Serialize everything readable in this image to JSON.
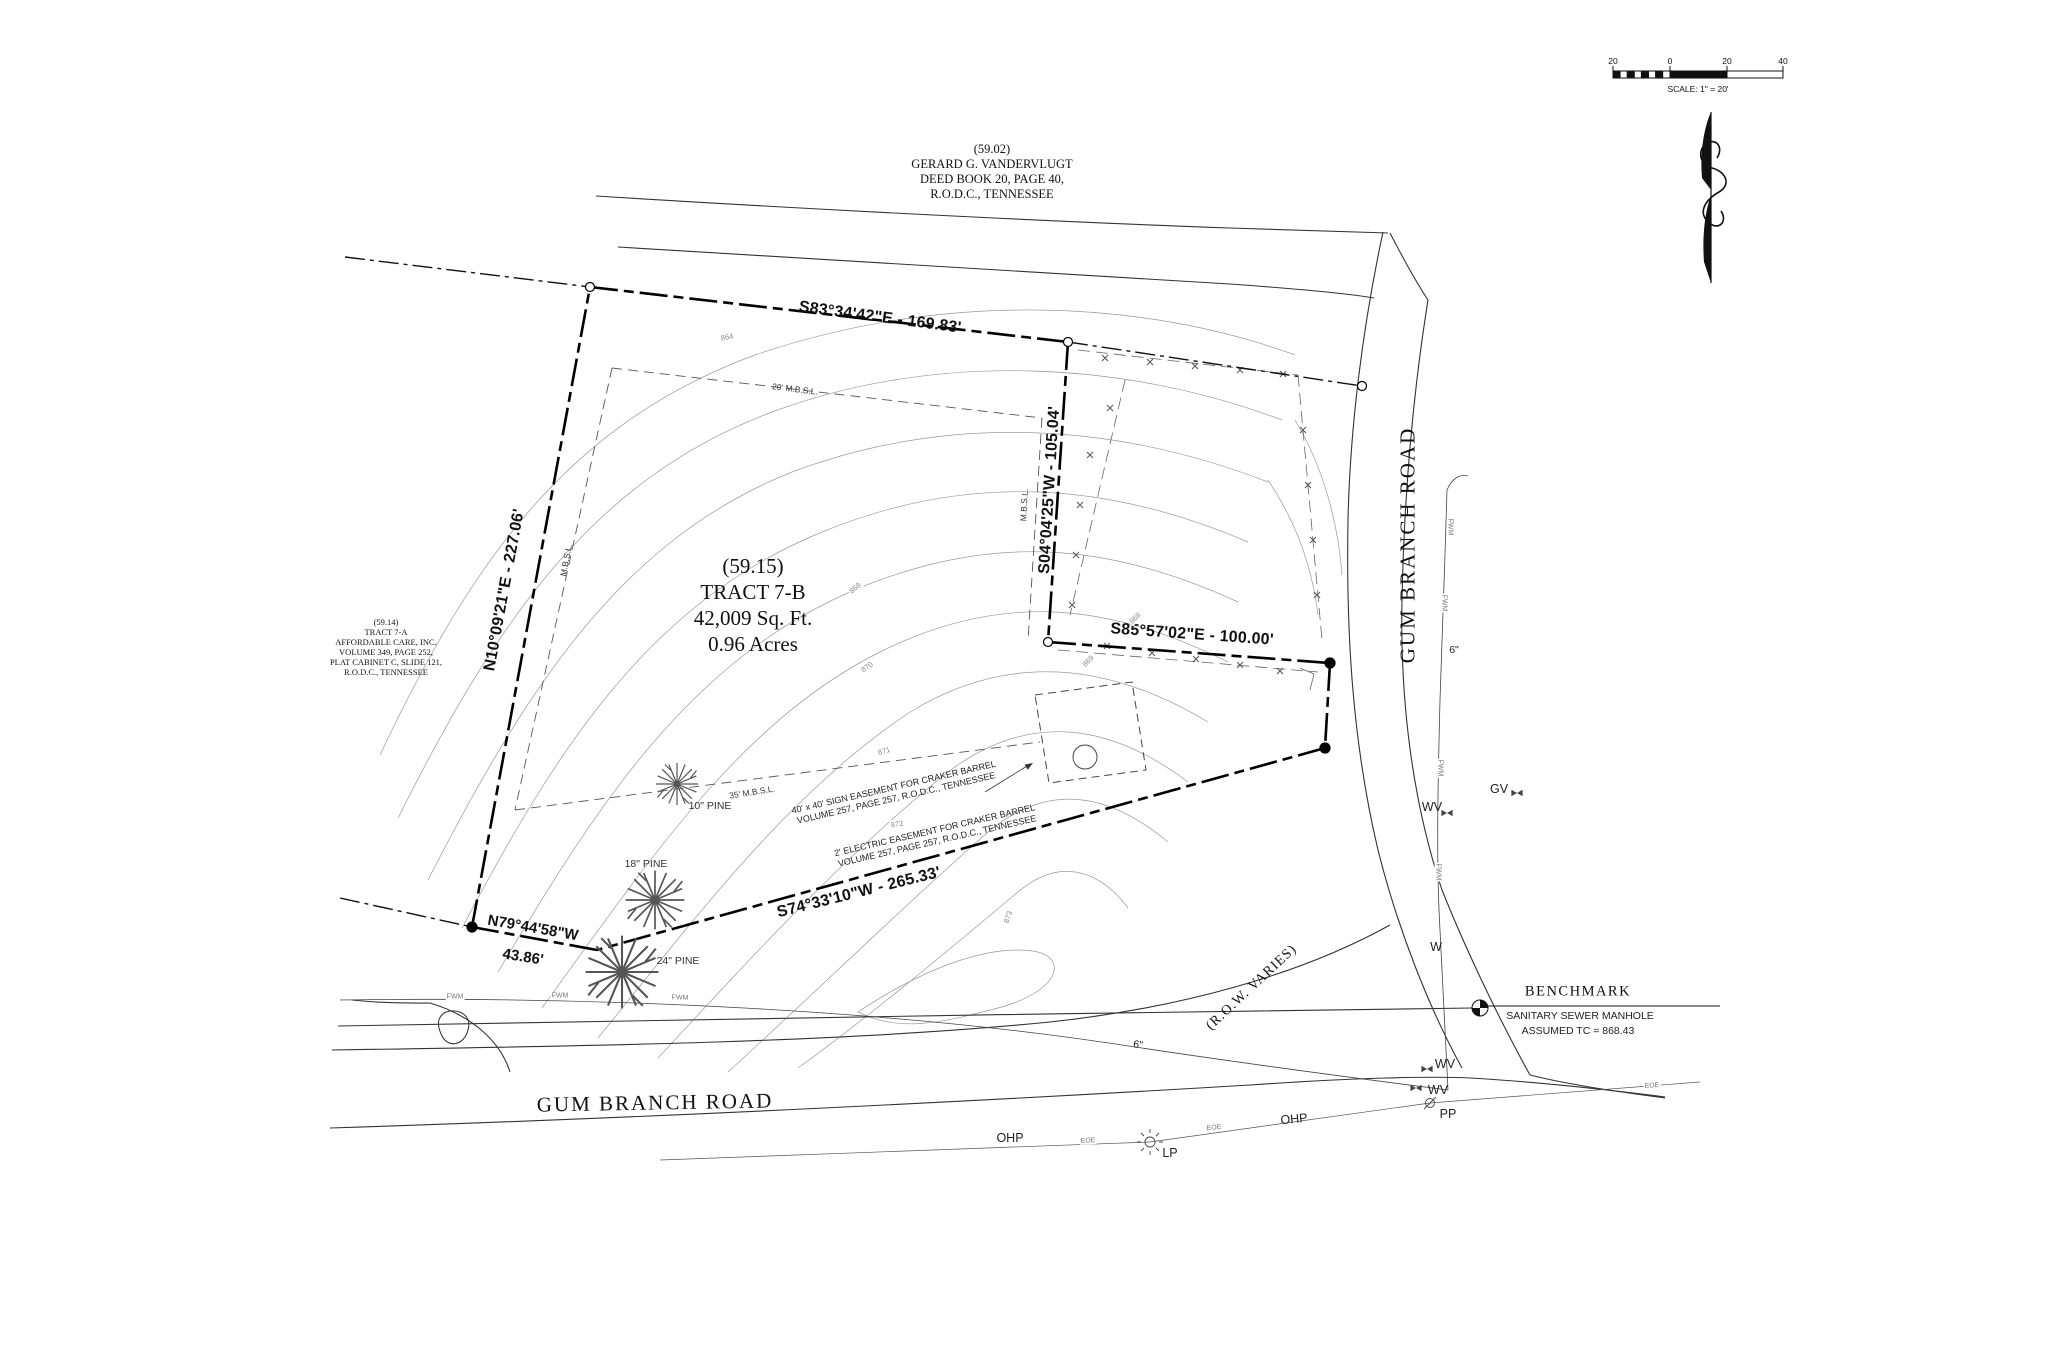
{
  "parcels": {
    "north": {
      "id": "(59.02)",
      "owner": "GERARD G. VANDERVLUGT",
      "deed": "DEED BOOK 20, PAGE 40,",
      "registry": "R.O.D.C., TENNESSEE"
    },
    "west": {
      "id": "(59.14)",
      "tract": "TRACT 7-A",
      "owner": "AFFORDABLE CARE, INC.",
      "volume": "VOLUME 349, PAGE 252,",
      "plat": "PLAT CABINET C, SLIDE 121,",
      "registry": "R.O.D.C., TENNESSEE"
    },
    "subject": {
      "id": "(59.15)",
      "tract": "TRACT 7-B",
      "area_sqft": "42,009 Sq. Ft.",
      "area_acres": "0.96 Acres"
    }
  },
  "bearings": {
    "north": "S83°34'42\"E - 169.83'",
    "west": "N10°09'21\"E - 227.06'",
    "east": "S04°04'25\"W - 105.04'",
    "southeast": "S85°57'02\"E - 100.00'",
    "south": "S74°33'10\"W - 265.33'",
    "southwest": "N79°44'58\"W",
    "southwest_dist": "43.86'"
  },
  "setbacks": {
    "front": "20' M.B.S.L.",
    "rear": "35' M.B.S.L.",
    "side": "M.B.S.L."
  },
  "easements": {
    "sign1": "40' x 40' SIGN EASEMENT FOR CRAKER BARREL",
    "sign2": "VOLUME 257, PAGE 257, R.O.D.C., TENNESSEE",
    "electric1": "2' ELECTRIC EASEMENT FOR CRAKER BARREL",
    "electric2": "VOLUME 257, PAGE 257, R.O.D.C., TENNESSEE"
  },
  "roads": {
    "east": "GUM BRANCH ROAD",
    "south": "GUM BRANCH ROAD",
    "row": "(R.O.W. VARIES)"
  },
  "benchmark": {
    "title": "BENCHMARK",
    "line1": "SANITARY SEWER MANHOLE",
    "line2": "ASSUMED TC = 868.43"
  },
  "scale_bar": {
    "t1": "20",
    "t2": "0",
    "t3": "20",
    "t4": "40",
    "label": "SCALE:  1\" = 20'"
  },
  "trees": {
    "pine10": "10\" PINE",
    "pine18": "18\" PINE",
    "pine24": "24\" PINE"
  },
  "utilities": {
    "ohp": "OHP",
    "eoe": "EOE",
    "lp": "LP",
    "pp": "PP",
    "wv": "WV",
    "gv": "GV",
    "w": "W",
    "fwm": "FWM",
    "size6": "6\""
  },
  "contours": {
    "c864": "864",
    "c868": "868",
    "c869": "869",
    "c870": "870",
    "c871": "871",
    "c872": "872",
    "c873": "873"
  }
}
